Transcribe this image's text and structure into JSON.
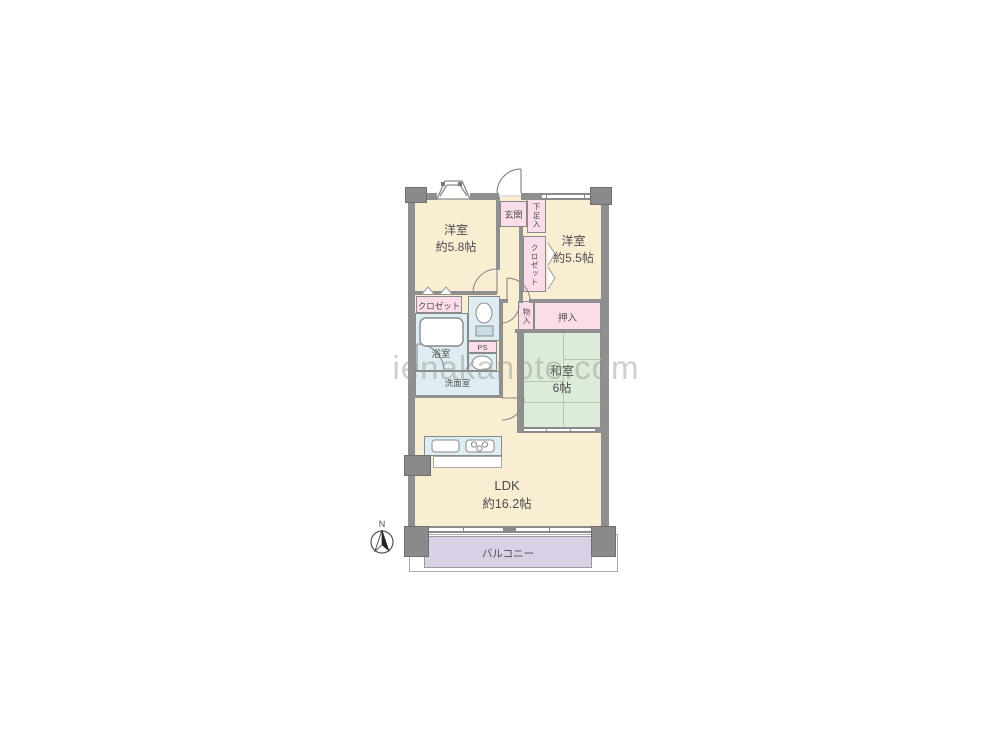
{
  "watermark": "ienakanote.com",
  "compass": {
    "label": "N"
  },
  "colors": {
    "room_cream": "#f9edd2",
    "storage_pink": "#fadde8",
    "wet_area_blue": "#ddedf2",
    "tatami_green": "#ddecd9",
    "balcony_lavender": "#d9d0e5",
    "wall_gray": "#8f8f8f",
    "text_gray": "#4d4d4d"
  },
  "rooms": {
    "western1": {
      "name": "洋室",
      "size": "約5.8帖"
    },
    "western2": {
      "name": "洋室",
      "size": "約5.5帖"
    },
    "japanese": {
      "name": "和室",
      "size": "6帖"
    },
    "ldk": {
      "name": "LDK",
      "size": "約16.2帖"
    },
    "balcony": {
      "name": "バルコニー"
    },
    "entrance": {
      "name": "玄関"
    },
    "shoe_cabinet": {
      "name": "下足入"
    },
    "closet_west2": {
      "name": "クロゼット"
    },
    "closet_west1": {
      "name": "クロゼット"
    },
    "bath": {
      "name": "浴室"
    },
    "washroom": {
      "name": "洗面室"
    },
    "pipe_space": {
      "name": "PS"
    },
    "oshiire": {
      "name": "押入"
    },
    "storage_small": {
      "name": "物入"
    }
  }
}
